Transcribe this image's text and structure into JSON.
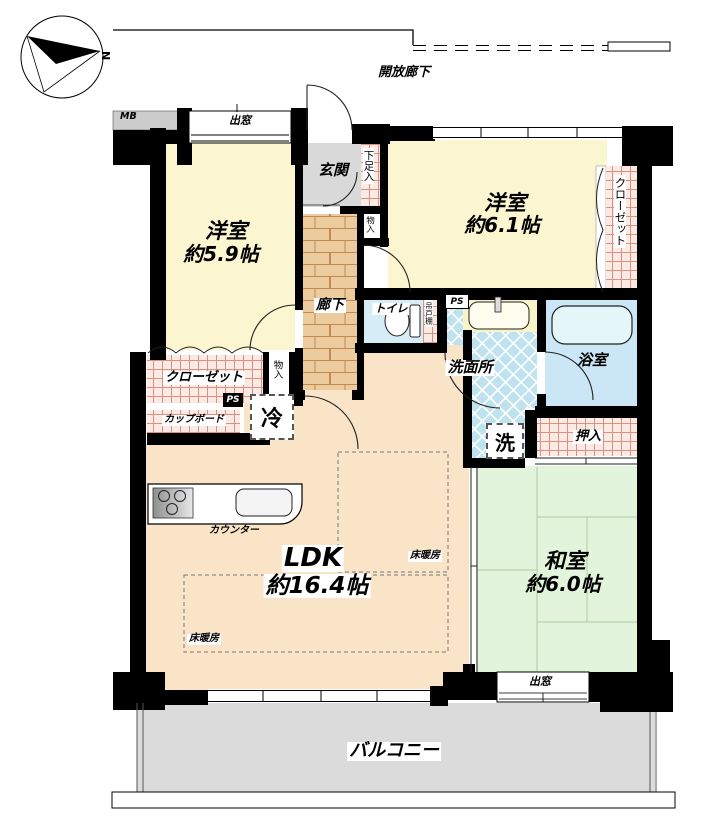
{
  "labels": {
    "compass_n": "N",
    "open_corridor": "開放廊下",
    "mb": "MB",
    "bay_window_top": "出窓",
    "bay_window_bottom": "出窓",
    "entrance": "玄関",
    "shoe_cabinet": "下足入",
    "storage_top": "物入",
    "storage_left": "物入",
    "western_room_left_name": "洋室",
    "western_room_left_size": "約5.9帖",
    "western_room_right_name": "洋室",
    "western_room_right_size": "約6.1帖",
    "closet_left": "クローゼット",
    "closet_right": "クローゼット",
    "corridor": "廊下",
    "toilet": "トイレ",
    "hanging_cupboard": "吊戸棚",
    "ps_left": "PS",
    "ps_right": "PS",
    "washroom": "洗面所",
    "bathroom": "浴室",
    "laundry": "洗",
    "fridge": "冷",
    "cupboard": "カップボード",
    "counter": "カウンター",
    "ldk_name": "LDK",
    "ldk_size": "約16.4帖",
    "floor_heating_1": "床暖房",
    "floor_heating_2": "床暖房",
    "oshiire": "押入",
    "japanese_room_name": "和室",
    "japanese_room_size": "約6.0帖",
    "balcony": "バルコニー"
  },
  "colors": {
    "wall": "#000000",
    "western_room": "#FBF6CF",
    "ldk": "#F9E4C8",
    "entrance_gray": "#D9D9D9",
    "corridor_brick": "#ECCB9F",
    "closet_pink": "#FBEAE3",
    "washroom_blue": "#BFE2EF",
    "bathroom_blue": "#CBE7F5",
    "japanese_room_green": "#E3F4DC",
    "balcony_gray": "#DBDBDB"
  }
}
